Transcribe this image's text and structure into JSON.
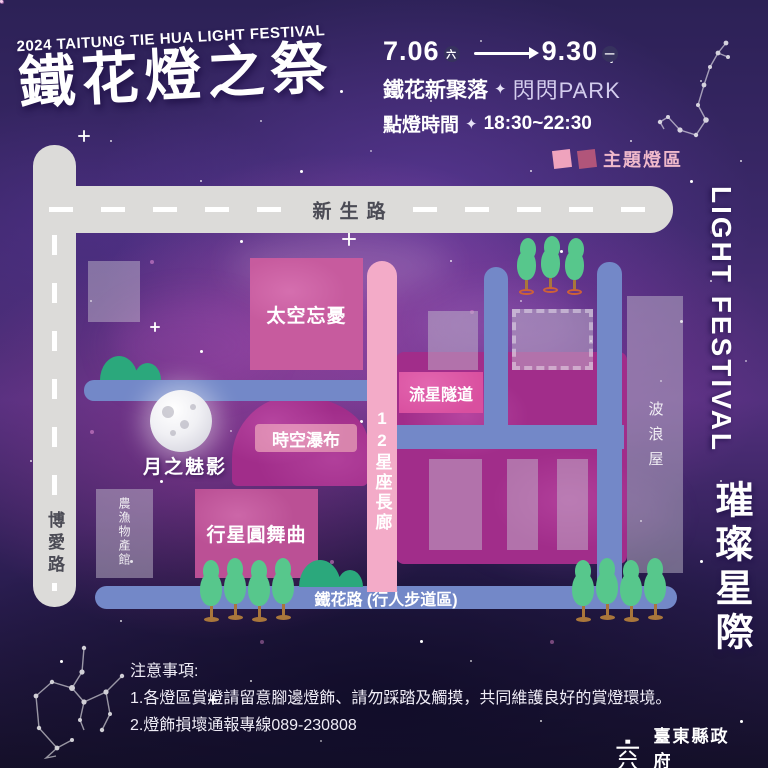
{
  "poster": {
    "subtitle_en": "2024 TAITUNG TIE HUA LIGHT FESTIVAL",
    "title": "鐵花燈之祭",
    "dates": {
      "start": "7.06",
      "start_day": "六",
      "end": "9.30",
      "end_day": "一"
    },
    "venue": {
      "name": "鐵花新聚落",
      "sparkle": "✦",
      "park": "閃閃PARK"
    },
    "lighting": {
      "label": "點燈時間",
      "sparkle": "✦",
      "time": "18:30~22:30"
    },
    "legend": {
      "label": "主題燈區"
    }
  },
  "map": {
    "roads": {
      "xinsheng": "新生路",
      "boai": "博愛路",
      "tiehua": "鐵花路 (行人步道區)",
      "corridor": "12星座長廊"
    },
    "zones": {
      "space_oblivion": "太空忘憂",
      "time_waterfall": "時空瀑布",
      "moon_shadow": "月之魅影",
      "planet_waltz": "行星圓舞曲",
      "meteor_tunnel": "流星隧道"
    },
    "buildings": {
      "farm_market": "農漁物產館",
      "wave_house": "波浪屋"
    }
  },
  "sidebar": {
    "en": "LIGHT FESTIVAL",
    "zh": "璀璨星際"
  },
  "notes": {
    "title": "注意事項:",
    "items": [
      "1.各燈區賞燈請留意腳邊燈飾、請勿踩踏及觸摸，共同維護良好的賞燈環境。",
      "2.燈飾損壞通報專線089-230808"
    ]
  },
  "footer": {
    "org_zh": "臺東縣政府",
    "org_en": "Taitung County Government"
  },
  "colors": {
    "road_gray": "#dcdbd9",
    "road_blue": "#7388c8",
    "corridor_pink": "#f3abc8",
    "zone_magenta": "#a12d8a",
    "block_pink": "#c75b9e",
    "legend_pink": "#efa3bd",
    "legend_rose": "#b1557a",
    "tree_green": "#57c78c",
    "mound_teal": "#2ba87c"
  }
}
